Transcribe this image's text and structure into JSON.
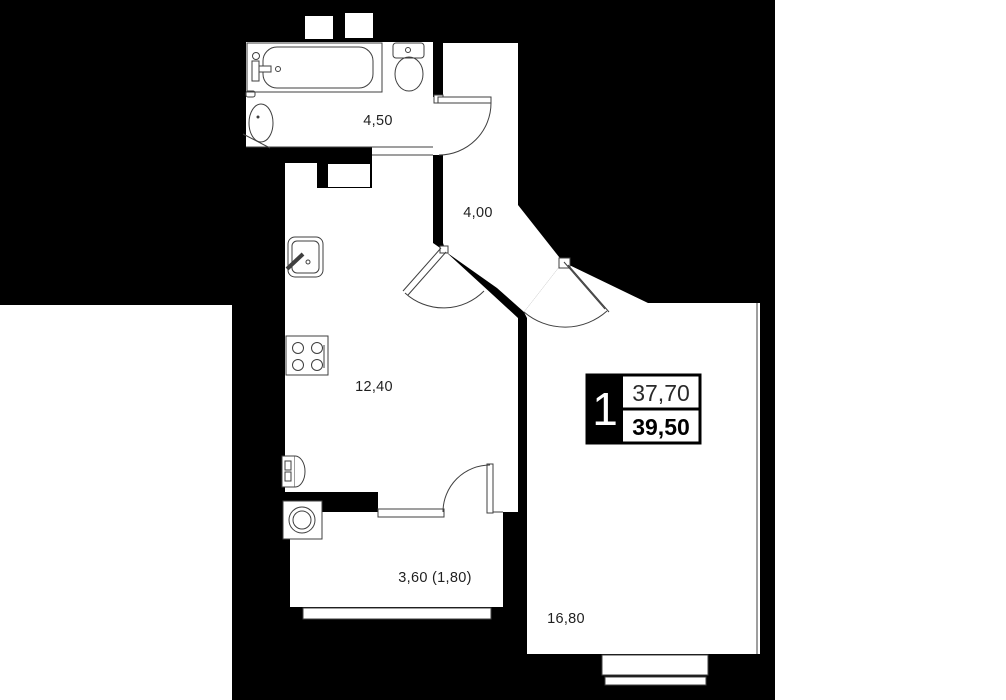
{
  "plan": {
    "type": "apartment-floor-plan",
    "unit_badge": {
      "number": "1",
      "area_upper": "37,70",
      "area_lower": "39,50"
    },
    "rooms": {
      "bathroom": {
        "area_label": "4,50"
      },
      "hallway": {
        "area_label": "4,00"
      },
      "kitchen_living": {
        "area_label": "12,40"
      },
      "balcony": {
        "area_label": "3,60 (1,80)"
      },
      "living_room": {
        "area_label": "16,80"
      }
    },
    "fixtures": [
      "bathtub-icon",
      "toilet-icon",
      "bathroom-sink-icon",
      "kitchen-sink-icon",
      "stove-icon",
      "radiator-icon",
      "washing-machine-icon"
    ],
    "colors": {
      "building_mass": "#000000",
      "floor": "#ffffff",
      "line": "#3f3f3f",
      "text": "#1f1f1f"
    }
  }
}
